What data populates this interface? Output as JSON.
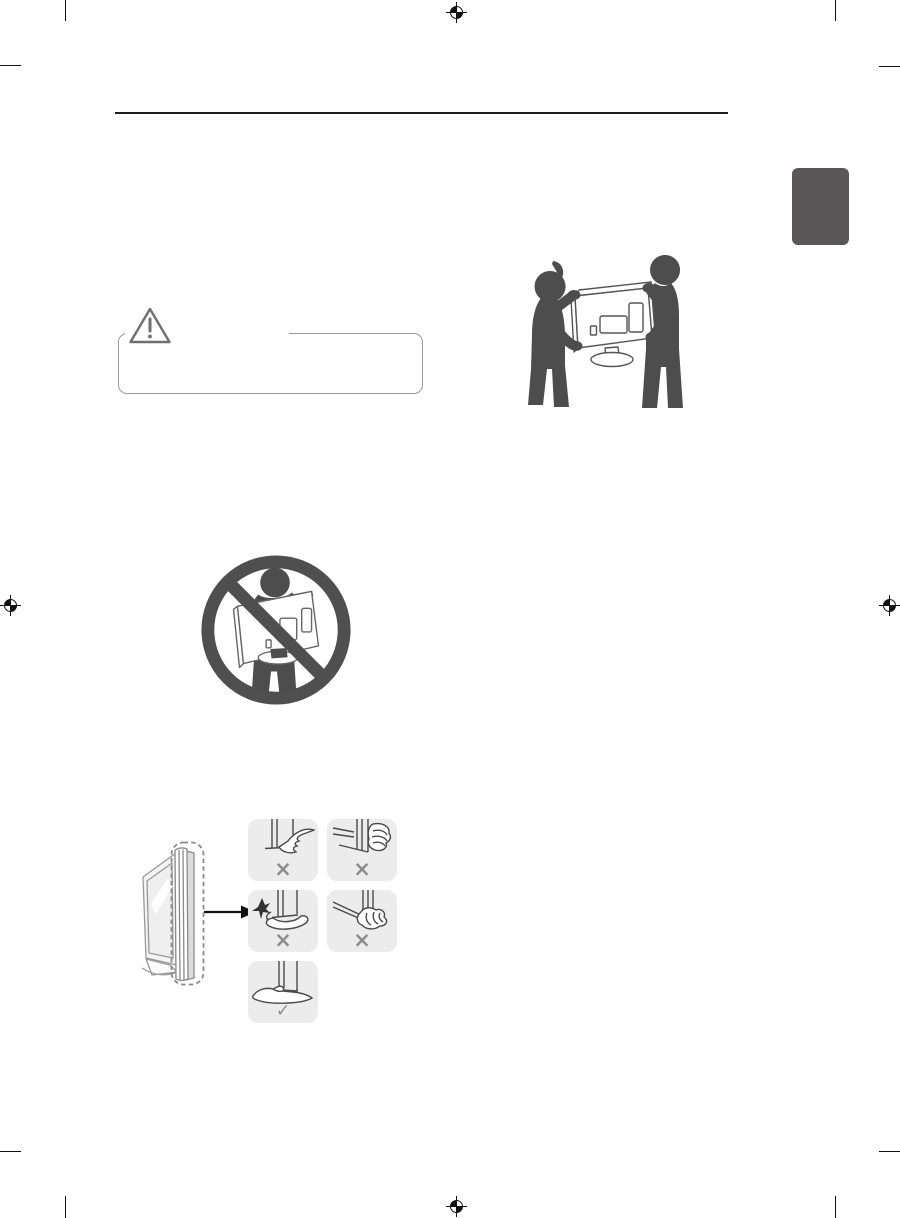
{
  "page": {
    "kind": "tv-owners-manual-scan-page",
    "background": "#ffffff"
  },
  "header": {
    "rule_color": "#1f1f1f"
  },
  "section_tab": {
    "color": "#595757"
  },
  "print_marks": {
    "crop_mark_color": "#111111",
    "registration_icon": "registration-target-icon",
    "registration_positions": [
      "top-center",
      "left-middle",
      "right-middle",
      "bottom-center"
    ]
  },
  "caution_box": {
    "icon": "warning-triangle-icon",
    "border_color": "#9a9a9a"
  },
  "illustrations": {
    "two_person_carry": {
      "name": "carry-tv-with-two-people",
      "silhouette_color": "#4d4d4d",
      "tv_outline_color": "#555555"
    },
    "no_single_person_carry": {
      "name": "do-not-carry-alone",
      "prohibition_color": "#4f4f4f",
      "silhouette_color": "#4d4d4d"
    },
    "panel_grip_guide": {
      "name": "do-not-grip-panel-guide",
      "tile_background": "#ececec",
      "mark_color": "#8c8c8c",
      "tiles": [
        {
          "name": "grip-front-bottom-edge",
          "verdict": "×"
        },
        {
          "name": "grip-top-side-edge",
          "verdict": "×"
        },
        {
          "name": "press-screen-surface",
          "verdict": "×"
        },
        {
          "name": "grip-rear-bottom-edge",
          "verdict": "×"
        },
        {
          "name": "support-bottom-with-flat-hand",
          "verdict": "✓"
        }
      ]
    }
  }
}
